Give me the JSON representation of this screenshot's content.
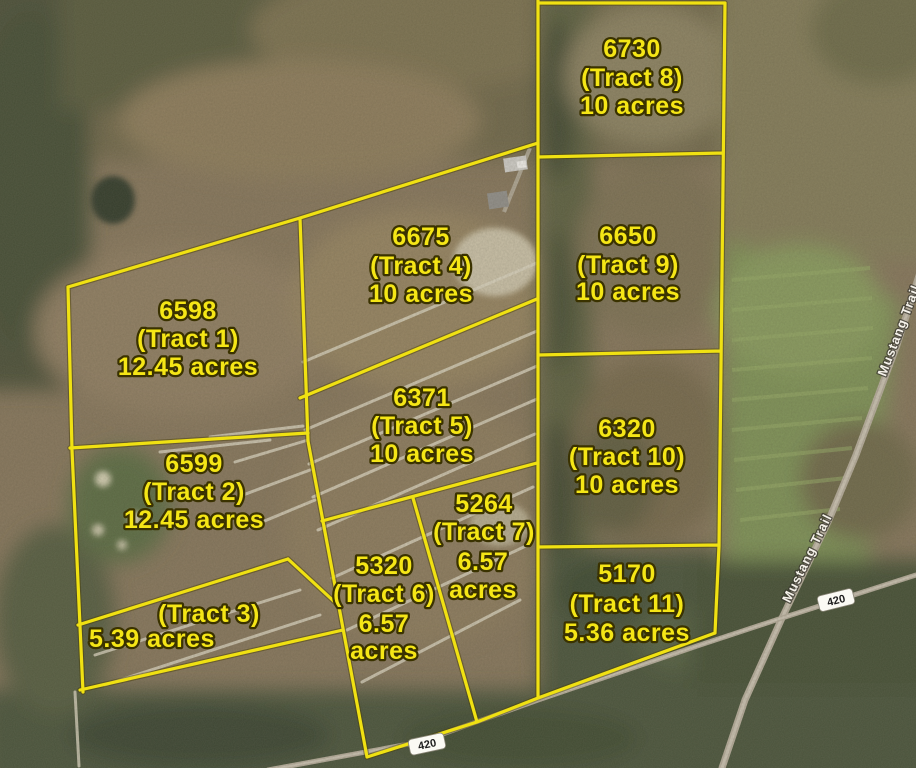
{
  "tracts": [
    {
      "number": "6730",
      "name": "(Tract 8)",
      "acreage": "10 acres"
    },
    {
      "number": "6675",
      "name": "(Tract 4)",
      "acreage": "10 acres"
    },
    {
      "number": "6650",
      "name": "(Tract 9)",
      "acreage": "10 acres"
    },
    {
      "number": "6598",
      "name": "(Tract 1)",
      "acreage": "12.45 acres"
    },
    {
      "number": "6371",
      "name": "(Tract 5)",
      "acreage": "10 acres"
    },
    {
      "number": "6320",
      "name": "(Tract 10)",
      "acreage": "10 acres"
    },
    {
      "number": "6599",
      "name": "(Tract 2)",
      "acreage": "12.45 acres"
    },
    {
      "number": "5264",
      "name": "(Tract 7)",
      "acreage_value": "6.57",
      "acreage_unit": "acres"
    },
    {
      "number": "5320",
      "name": "(Tract 6)",
      "acreage_value": "6.57",
      "acreage_unit": "acres"
    },
    {
      "name": "(Tract 3)",
      "acreage": "5.39 acres"
    },
    {
      "number": "5170",
      "name": "(Tract 11)",
      "acreage": "5.36 acres"
    }
  ],
  "roads": {
    "mustang_trail": "Mustang Trail",
    "route_badge": "420"
  }
}
